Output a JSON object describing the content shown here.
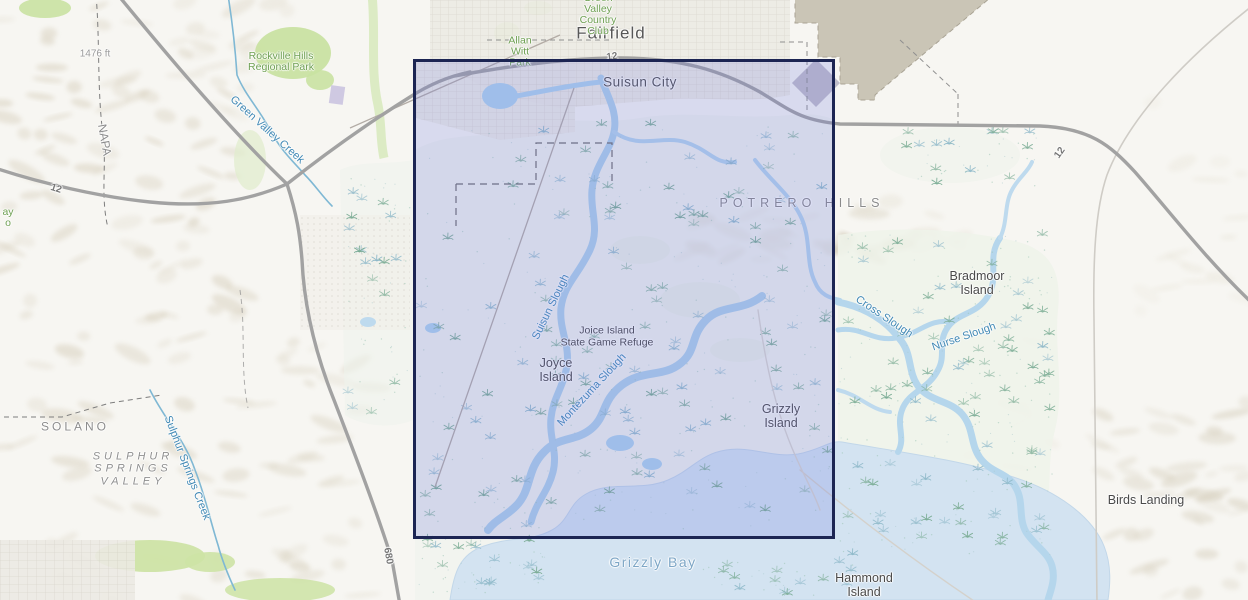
{
  "canvas": {
    "width": 1248,
    "height": 600
  },
  "colors": {
    "land": "#f7f6f2",
    "urban": "#ecebe4",
    "urban_grid_line": "#d9d5cc",
    "hills_shade": "#d5cdba",
    "park_green": "#c9e2a2",
    "marsh_bg": "#edf2ec",
    "marsh_tuft": "#79ab93",
    "marsh_tuft_alt": "#8fb9c9",
    "water": "#b7d8ec",
    "bay": "#d3e3f1",
    "road_major": "#a2a2a2",
    "road_minor": "#cfccc6",
    "rail": "#b3aca6",
    "boundary": "#8f8f8f",
    "military_area": "#c8c3b3",
    "extent_fill": "rgba(110,120,225,0.22)",
    "extent_border": "#1c2553"
  },
  "extent_rectangle": {
    "x": 413,
    "y": 59,
    "width": 422,
    "height": 480
  },
  "map_labels": [
    {
      "t": "Fairfield",
      "x": 611,
      "y": 33,
      "c": "city-lg"
    },
    {
      "t": "Suisun City",
      "x": 640,
      "y": 82,
      "c": "city"
    },
    {
      "t": "Allan\nWitt\nPark",
      "x": 520,
      "y": 52,
      "c": "park"
    },
    {
      "t": "Green\nValley\nCountry\nClub",
      "x": 598,
      "y": 15,
      "c": "park"
    },
    {
      "t": "Rockville Hills\nRegional Park",
      "x": 281,
      "y": 62,
      "c": "park"
    },
    {
      "t": "1476 ft",
      "x": 95,
      "y": 54,
      "c": "elev"
    },
    {
      "t": "NAPA",
      "x": 104,
      "y": 140,
      "r": 80,
      "c": "county"
    },
    {
      "t": "Green Valley Creek",
      "x": 267,
      "y": 130,
      "r": 42,
      "c": "water"
    },
    {
      "t": "12",
      "x": 56,
      "y": 189,
      "r": 18,
      "c": "route"
    },
    {
      "t": "12",
      "x": 612,
      "y": 57,
      "r": -8,
      "c": "route"
    },
    {
      "t": "12",
      "x": 1060,
      "y": 153,
      "r": -55,
      "c": "route"
    },
    {
      "t": "680",
      "x": 388,
      "y": 556,
      "r": 80,
      "c": "route"
    },
    {
      "t": "SOLANO",
      "x": 75,
      "y": 427,
      "s": 3,
      "c": "county"
    },
    {
      "t": "SULPHUR\nSPRINGS\nVALLEY",
      "x": 133,
      "y": 469,
      "s": 4,
      "c": "valley"
    },
    {
      "t": "Sulphur Springs Creek",
      "x": 187,
      "y": 468,
      "r": 69,
      "c": "water"
    },
    {
      "t": "ay\no",
      "x": 8,
      "y": 218,
      "c": "park"
    },
    {
      "t": "POTRERO HILLS",
      "x": 802,
      "y": 203,
      "s": 5,
      "c": "hills"
    },
    {
      "t": "Bradmoor\nIsland",
      "x": 977,
      "y": 283,
      "c": "place"
    },
    {
      "t": "Cross Slough",
      "x": 884,
      "y": 317,
      "r": 34,
      "c": "water"
    },
    {
      "t": "Nurse Slough",
      "x": 964,
      "y": 337,
      "r": -19,
      "c": "water"
    },
    {
      "t": "Joice Island\nState Game Refuge",
      "x": 607,
      "y": 337,
      "c": "place-sm"
    },
    {
      "t": "Joyce\nIsland",
      "x": 556,
      "y": 370,
      "c": "place"
    },
    {
      "t": "Montezuma Slough",
      "x": 592,
      "y": 390,
      "r": -47,
      "c": "water"
    },
    {
      "t": "Suisun Slough",
      "x": 551,
      "y": 307,
      "r": -64,
      "c": "water"
    },
    {
      "t": "Grizzly\nIsland",
      "x": 781,
      "y": 416,
      "c": "place"
    },
    {
      "t": "Grizzly Bay",
      "x": 653,
      "y": 563,
      "c": "water-lg"
    },
    {
      "t": "Hammond\nIsland",
      "x": 864,
      "y": 585,
      "c": "place"
    },
    {
      "t": "Birds Landing",
      "x": 1146,
      "y": 500,
      "c": "place"
    }
  ]
}
